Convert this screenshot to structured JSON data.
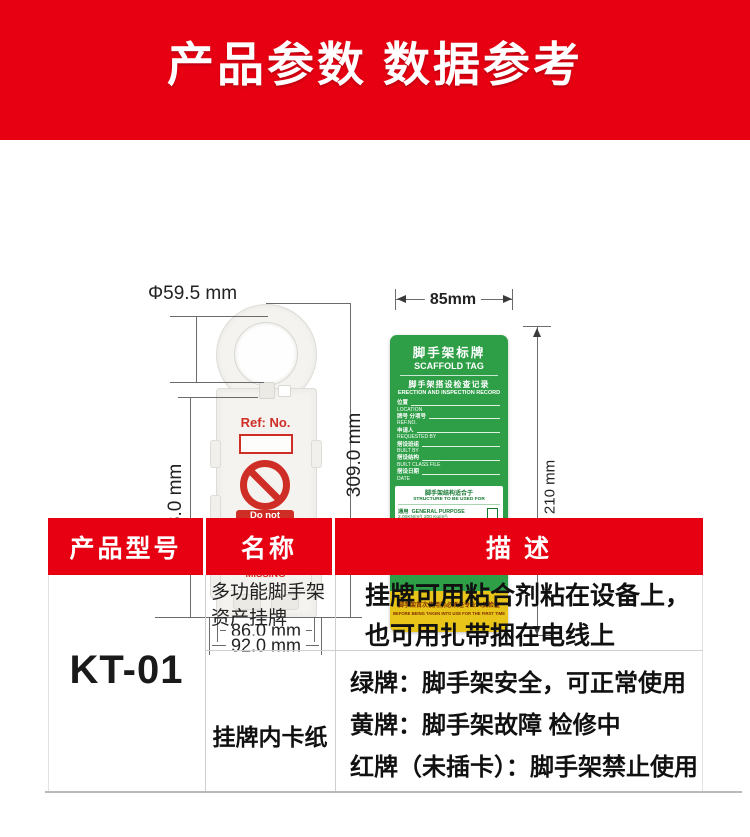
{
  "banner": {
    "title": "产品参数 数据参考"
  },
  "colors": {
    "banner_red": "#e60012",
    "tag_print_red": "#cf2e27",
    "card_green": "#2e9f47",
    "card_yellow": "#e9c51a"
  },
  "tag_diagram": {
    "ref_label": "Ref: No.",
    "warning_lines": [
      "Do not",
      "use this",
      "equipment"
    ],
    "missing_lines": [
      "INFORMATION",
      "TAG IS",
      "MISSING"
    ],
    "dims": {
      "hole_diameter": "Φ59.5 mm",
      "inner_height": "213.0 mm",
      "total_height": "309.0 mm",
      "inner_width": "86.0 mm",
      "outer_width": "92.0 mm"
    }
  },
  "card_diagram": {
    "dims": {
      "width": "85mm",
      "height": "210 mm"
    },
    "title_cn": "脚手架标牌",
    "title_en": "SCAFFOLD TAG",
    "subtitle_cn": "脚手架搭设检查记录",
    "subtitle_en": "ERECTION AND INSPECTION RECORD",
    "fields": [
      {
        "cn": "位置",
        "en": "LOCATION"
      },
      {
        "cn": "牌号 分项号",
        "en": "REF.NO."
      },
      {
        "cn": "申请人",
        "en": "REQUESTED BY"
      },
      {
        "cn": "搭设班组",
        "en": "BUILT BY"
      },
      {
        "cn": "搭设结构",
        "en": "BUILT CLASS FILE"
      },
      {
        "cn": "搭设日期",
        "en": "DATE"
      }
    ],
    "structure_box": {
      "head_cn": "脚手架结构适合于",
      "head_en": "STRUCTURE TO BE USED FOR",
      "general_cn": "通用",
      "general_en": "GENERAL PURPOSE",
      "general_load": "2.00KN/m²( 200 Kg/m²)",
      "special_cn": "特殊用途",
      "special_en": "SPECIAL",
      "special_en2": "PURPOSE",
      "special_unit": "Kg/m²"
    },
    "signature_cn": "安环保卫部签名：",
    "signature_en": "signature of security department",
    "date_label": "日期  DATE:",
    "footer_cn": "脚手架首次使用前必须经专业人员检查",
    "footer_en": "BEFORE BEING TAKEN INTO USE FOR THE FIRST TIME"
  },
  "table": {
    "headers": [
      "产品型号",
      "名称",
      "描 述"
    ],
    "model": "KT-01",
    "row1": {
      "name_lines": [
        "多功能脚手架",
        "资产挂牌"
      ],
      "desc_lines": [
        "挂牌可用粘合剂粘在设备上，",
        "也可用扎带捆在电线上"
      ]
    },
    "row2": {
      "name": "挂牌内卡纸",
      "desc_lines": [
        "绿牌：脚手架安全，可正常使用",
        "黄牌：脚手架故障  检修中",
        "红牌（未插卡）：脚手架禁止使用"
      ]
    }
  }
}
